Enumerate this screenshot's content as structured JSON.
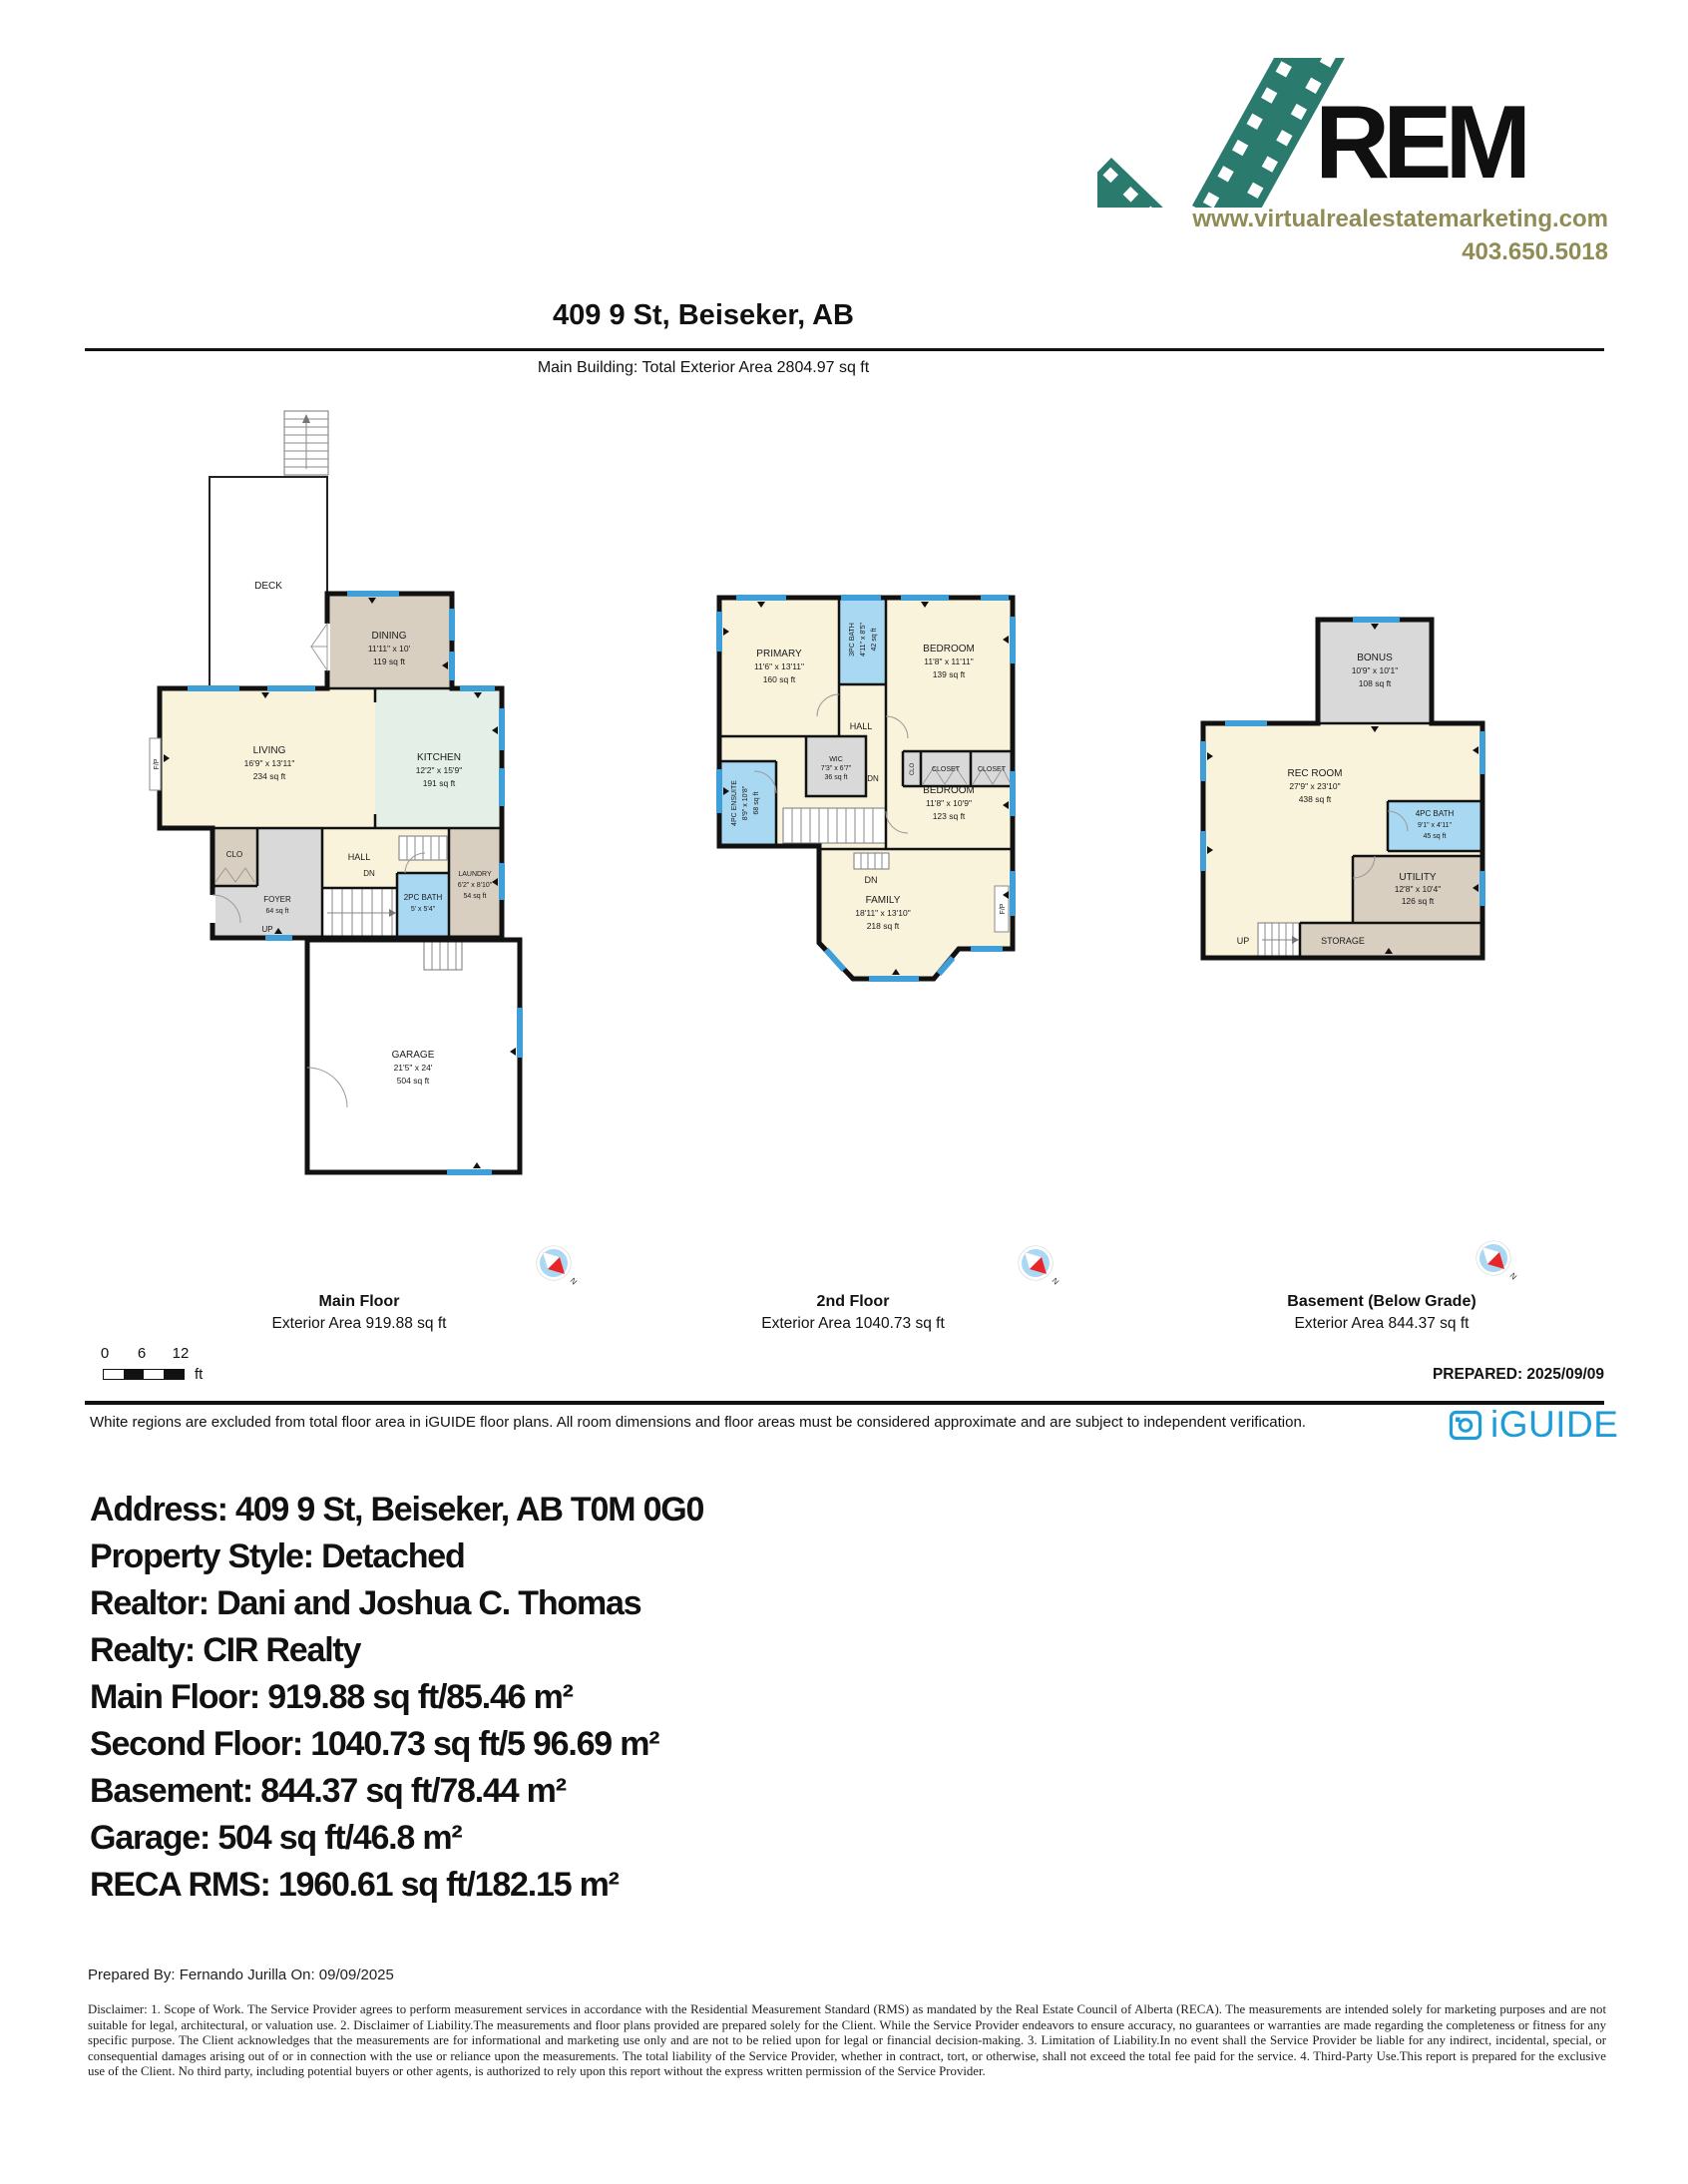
{
  "logo": {
    "brand_text": "REM",
    "website": "www.virtualrealestatemarketing.com",
    "phone": "403.650.5018"
  },
  "header": {
    "title": "409 9 St, Beiseker, AB",
    "subtitle": "Main Building: Total Exterior Area 2804.97 sq ft"
  },
  "main_floor": {
    "title": "Main Floor",
    "area": "Exterior Area 919.88 sq ft",
    "deck": "DECK",
    "dn_top": "DN",
    "dining": [
      "DINING",
      "11'11\" x 10'",
      "119 sq ft"
    ],
    "living": [
      "LIVING",
      "16'9\" x 13'11\"",
      "234 sq ft"
    ],
    "kitchen": [
      "KITCHEN",
      "12'2\" x 15'9\"",
      "191 sq ft"
    ],
    "clo": "CLO",
    "foyer": [
      "FOYER",
      "64 sq ft"
    ],
    "hall": "HALL",
    "dn": "DN",
    "up": "UP",
    "bath": [
      "2PC BATH",
      "5' x 5'4\""
    ],
    "laundry": [
      "LAUNDRY",
      "6'2\" x 8'10\"",
      "54 sq ft"
    ],
    "garage": [
      "GARAGE",
      "21'5\" x 24'",
      "504 sq ft"
    ],
    "fp": "F/P"
  },
  "second_floor": {
    "title": "2nd Floor",
    "area": "Exterior Area 1040.73 sq ft",
    "primary": [
      "PRIMARY",
      "11'6\" x 13'11\"",
      "160 sq ft"
    ],
    "bath3pc": [
      "3PC BATH",
      "4'11\" x 8'5\"",
      "42 sq ft"
    ],
    "bedroom1": [
      "BEDROOM",
      "11'8\" x 11'11\"",
      "139 sq ft"
    ],
    "hall": "HALL",
    "clo": "CLO",
    "closet1": "CLOSET",
    "closet2": "CLOSET",
    "wic": [
      "WIC",
      "7'3\" x 6'7\"",
      "36 sq ft"
    ],
    "ensuite": [
      "4PC ENSUITE",
      "8'9\" x 10'8\"",
      "68 sq ft"
    ],
    "bedroom2": [
      "BEDROOM",
      "11'8\" x 10'9\"",
      "123 sq ft"
    ],
    "family": [
      "FAMILY",
      "18'11\" x 13'10\"",
      "218 sq ft"
    ],
    "dn1": "DN",
    "dn2": "DN",
    "fp": "F/P"
  },
  "basement": {
    "title": "Basement (Below Grade)",
    "area": "Exterior Area 844.37 sq ft",
    "bonus": [
      "BONUS",
      "10'9\" x 10'1\"",
      "108 sq ft"
    ],
    "rec": [
      "REC ROOM",
      "27'9\" x 23'10\"",
      "438 sq ft"
    ],
    "bath4pc": [
      "4PC BATH",
      "9'1\" x 4'11\"",
      "45 sq ft"
    ],
    "utility": [
      "UTILITY",
      "12'8\" x 10'4\"",
      "126 sq ft"
    ],
    "storage": "STORAGE",
    "up": "UP"
  },
  "compass_label": "N",
  "scale_bar": {
    "ticks": [
      "0",
      "6",
      "12"
    ],
    "unit": "ft"
  },
  "prepared": "PREPARED: 2025/09/09",
  "footer_note": "White regions are excluded from total floor area in iGUIDE floor plans. All room dimensions and floor areas must be considered approximate and are subject to independent verification.",
  "iguide_wordmark": "iGUIDE",
  "property_info": [
    "Address: 409 9 St, Beiseker, AB T0M 0G0",
    "Property Style: Detached",
    "Realtor: Dani and Joshua C. Thomas",
    "Realty: CIR Realty",
    "Main Floor: 919.88 sq ft/85.46 m²",
    "Second Floor: 1040.73 sq ft/5 96.69 m²",
    "Basement: 844.37 sq ft/78.44 m²",
    "Garage: 504 sq ft/46.8 m²",
    "RECA RMS: 1960.61 sq ft/182.15 m²"
  ],
  "prepared_by": "Prepared By: Fernando Jurilla On: 09/09/2025",
  "legal_disclaimer": "Disclaimer: 1. Scope of Work. The Service Provider agrees to perform measurement services in accordance with the Residential Measurement Standard (RMS) as mandated by the Real Estate Council of Alberta (RECA). The measurements are intended solely for marketing purposes and are not suitable for legal, architectural, or valuation use. 2. Disclaimer of Liability.The measurements and floor plans provided are prepared solely for the Client. While the Service Provider endeavors to ensure accuracy, no guarantees or warranties are made regarding the completeness or fitness for any specific purpose. The Client acknowledges that the measurements are for informational and marketing use only and are not to be relied upon for legal or financial decision-making. 3. Limitation of Liability.In no event shall the Service Provider be liable for any indirect, incidental, special, or consequential damages arising out of or in connection with the use or reliance upon the measurements. The total liability of the Service Provider, whether in contract, tort, or otherwise, shall not exceed the total fee paid for the service. 4. Third-Party Use.This report is prepared for the exclusive use of the Client. No third party, including potential buyers or other agents, is authorized to rely upon this report without the express written permission of the Service Provider.",
  "colors": {
    "logo_teal": "#2b7a6e",
    "logo_olive": "#8f8c55",
    "iguide_blue": "#1e9cd7",
    "window_blue": "#3fa0d9",
    "room_cream": "#faf3dc",
    "room_tan": "#d9cfc0",
    "room_green": "#e3efe7",
    "room_bath_blue": "#a9d9f2",
    "room_gray": "#d9d9d9"
  }
}
